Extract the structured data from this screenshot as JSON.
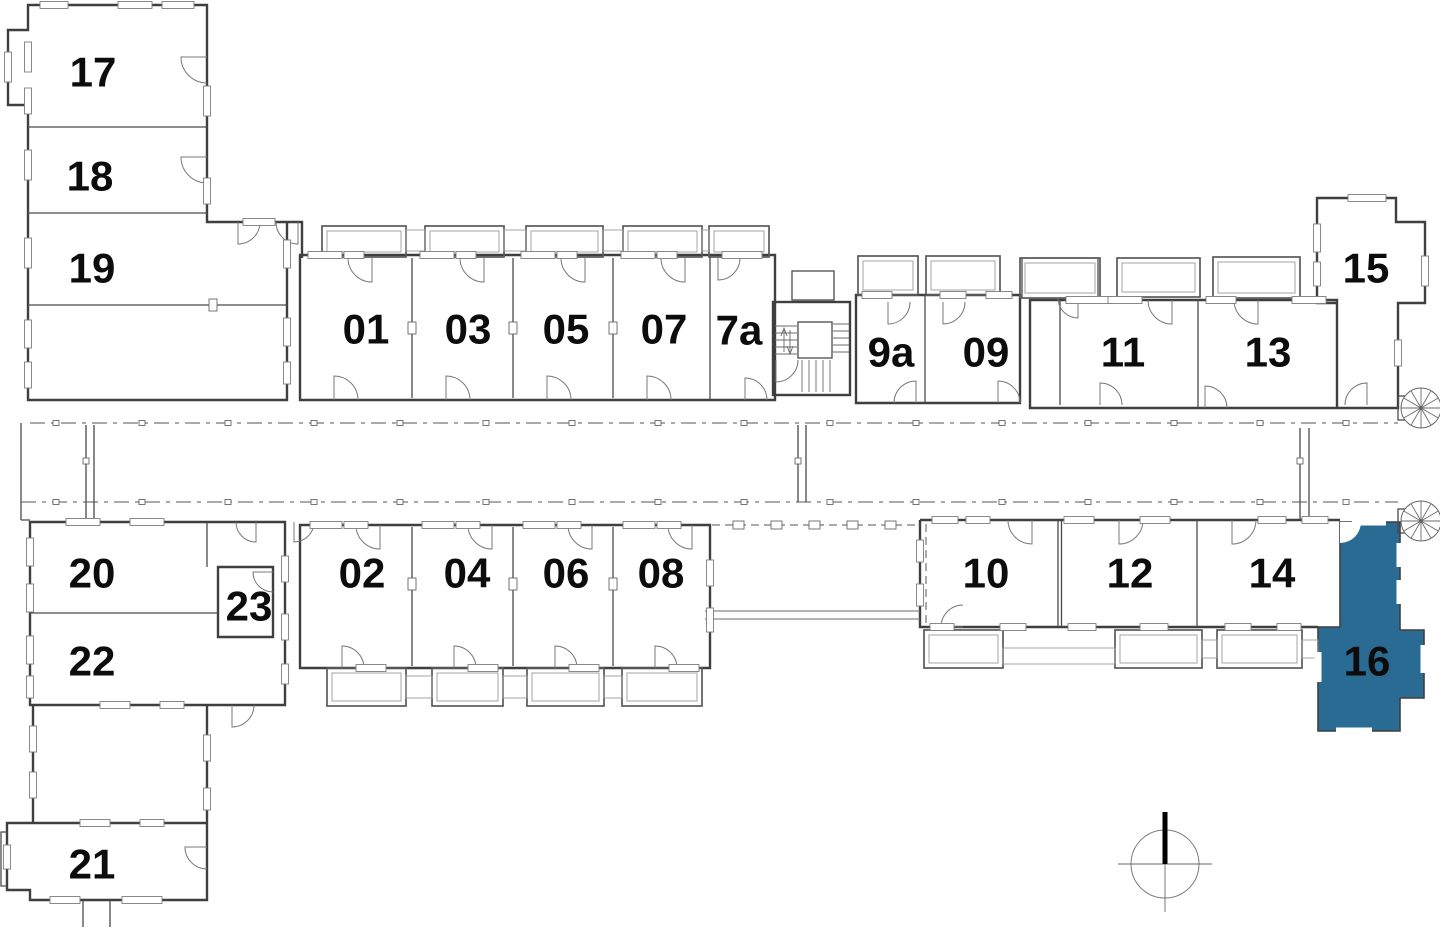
{
  "plan": {
    "type": "floor-plan",
    "background": "#ffffff",
    "wall_color": "#3f3f3f",
    "highlight_color": "#2a6b94",
    "selected_unit": "16",
    "units": [
      {
        "label": "17",
        "highlighted": false
      },
      {
        "label": "18",
        "highlighted": false
      },
      {
        "label": "19",
        "highlighted": false
      },
      {
        "label": "01",
        "highlighted": false
      },
      {
        "label": "03",
        "highlighted": false
      },
      {
        "label": "05",
        "highlighted": false
      },
      {
        "label": "07",
        "highlighted": false
      },
      {
        "label": "7a",
        "highlighted": false
      },
      {
        "label": "9a",
        "highlighted": false
      },
      {
        "label": "09",
        "highlighted": false
      },
      {
        "label": "11",
        "highlighted": false
      },
      {
        "label": "13",
        "highlighted": false
      },
      {
        "label": "15",
        "highlighted": false
      },
      {
        "label": "02",
        "highlighted": false
      },
      {
        "label": "04",
        "highlighted": false
      },
      {
        "label": "06",
        "highlighted": false
      },
      {
        "label": "08",
        "highlighted": false
      },
      {
        "label": "10",
        "highlighted": false
      },
      {
        "label": "12",
        "highlighted": false
      },
      {
        "label": "14",
        "highlighted": false
      },
      {
        "label": "16",
        "highlighted": true
      },
      {
        "label": "20",
        "highlighted": false
      },
      {
        "label": "23",
        "highlighted": false
      },
      {
        "label": "22",
        "highlighted": false
      },
      {
        "label": "21",
        "highlighted": false
      }
    ],
    "icons": {
      "compass": "north-compass-icon",
      "spiral_staircase": "spiral-staircase-icon",
      "staircase": "staircase-icon",
      "door": "door-swing-icon",
      "window": "window-icon"
    }
  }
}
